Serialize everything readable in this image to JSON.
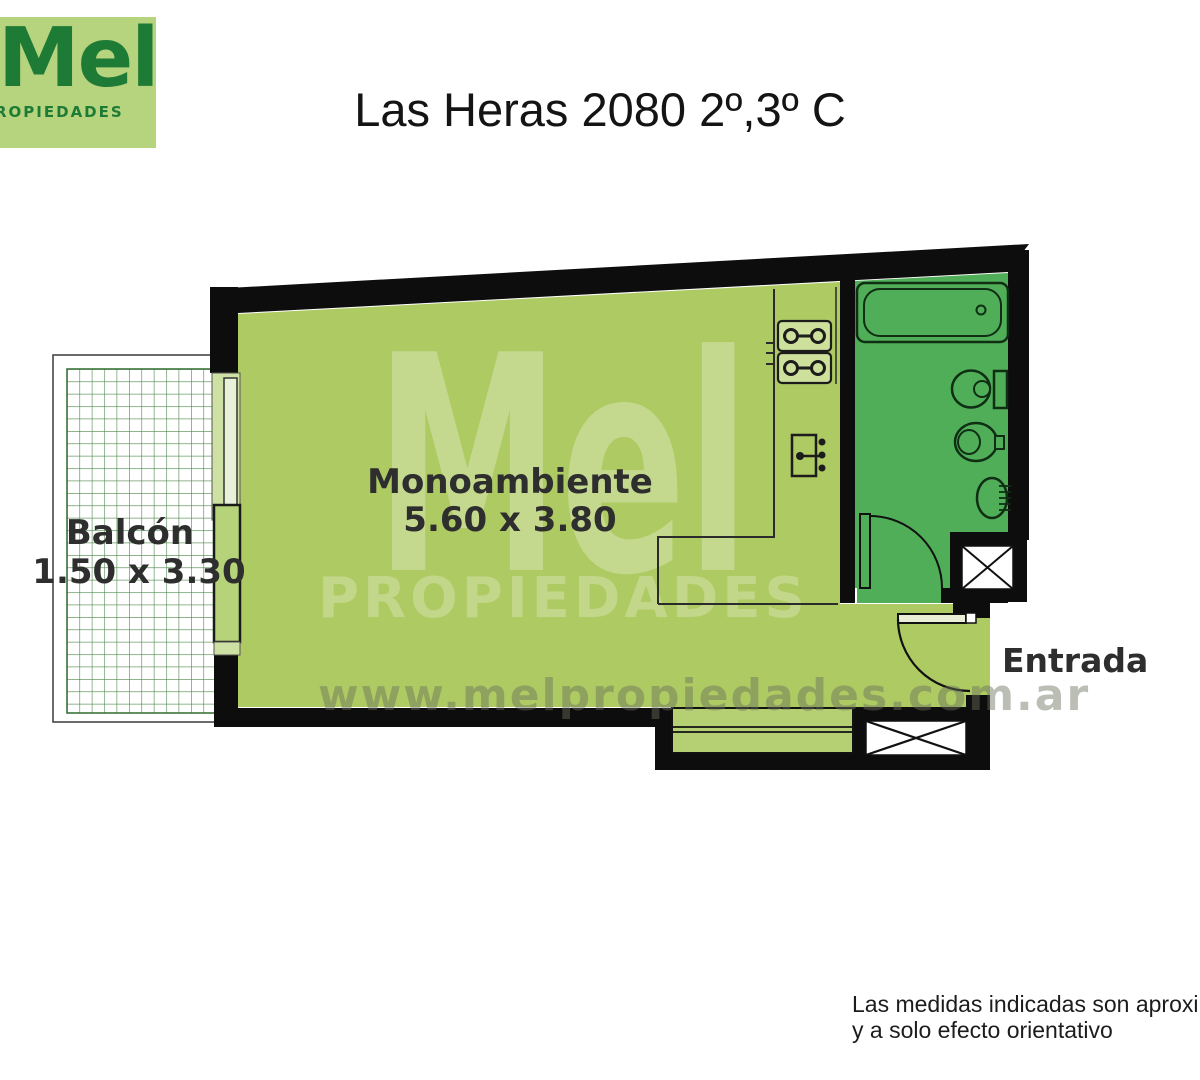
{
  "header": {
    "logo": {
      "name": "Mel",
      "subtitle": "PROPIEDADES"
    },
    "title": "Las Heras 2080 2º,3º C"
  },
  "plan": {
    "room": {
      "label": "Monoambiente",
      "dimensions": "5.60 x 3.80"
    },
    "balcony": {
      "label": "Balcón",
      "dimensions": "1.50 x 3.30"
    },
    "entrance": {
      "label": "Entrada"
    },
    "fixtures": [
      "bathtub",
      "toilet",
      "bidet",
      "sink",
      "stove-burners",
      "kitchen-sink-unit",
      "air-shaft",
      "air-shaft"
    ]
  },
  "watermark": {
    "brand": "Mel",
    "subtitle": "PROPIEDADES",
    "url": "www.melpropiedades.com.ar"
  },
  "footer": {
    "line1": "Las medidas indicadas son aproximadas",
    "line2": "y a solo efecto orientativo"
  },
  "colors": {
    "logo_background": "#b6d37e",
    "logo_text": "#1e7b35",
    "room_floor": "#aeca62",
    "bathroom_floor": "#4fae57",
    "walls": "#0d0d0d",
    "balcony_grid_line": "#4a8746",
    "label_text": "#2e2e2e",
    "watermark_url_text": "#6b705c"
  }
}
